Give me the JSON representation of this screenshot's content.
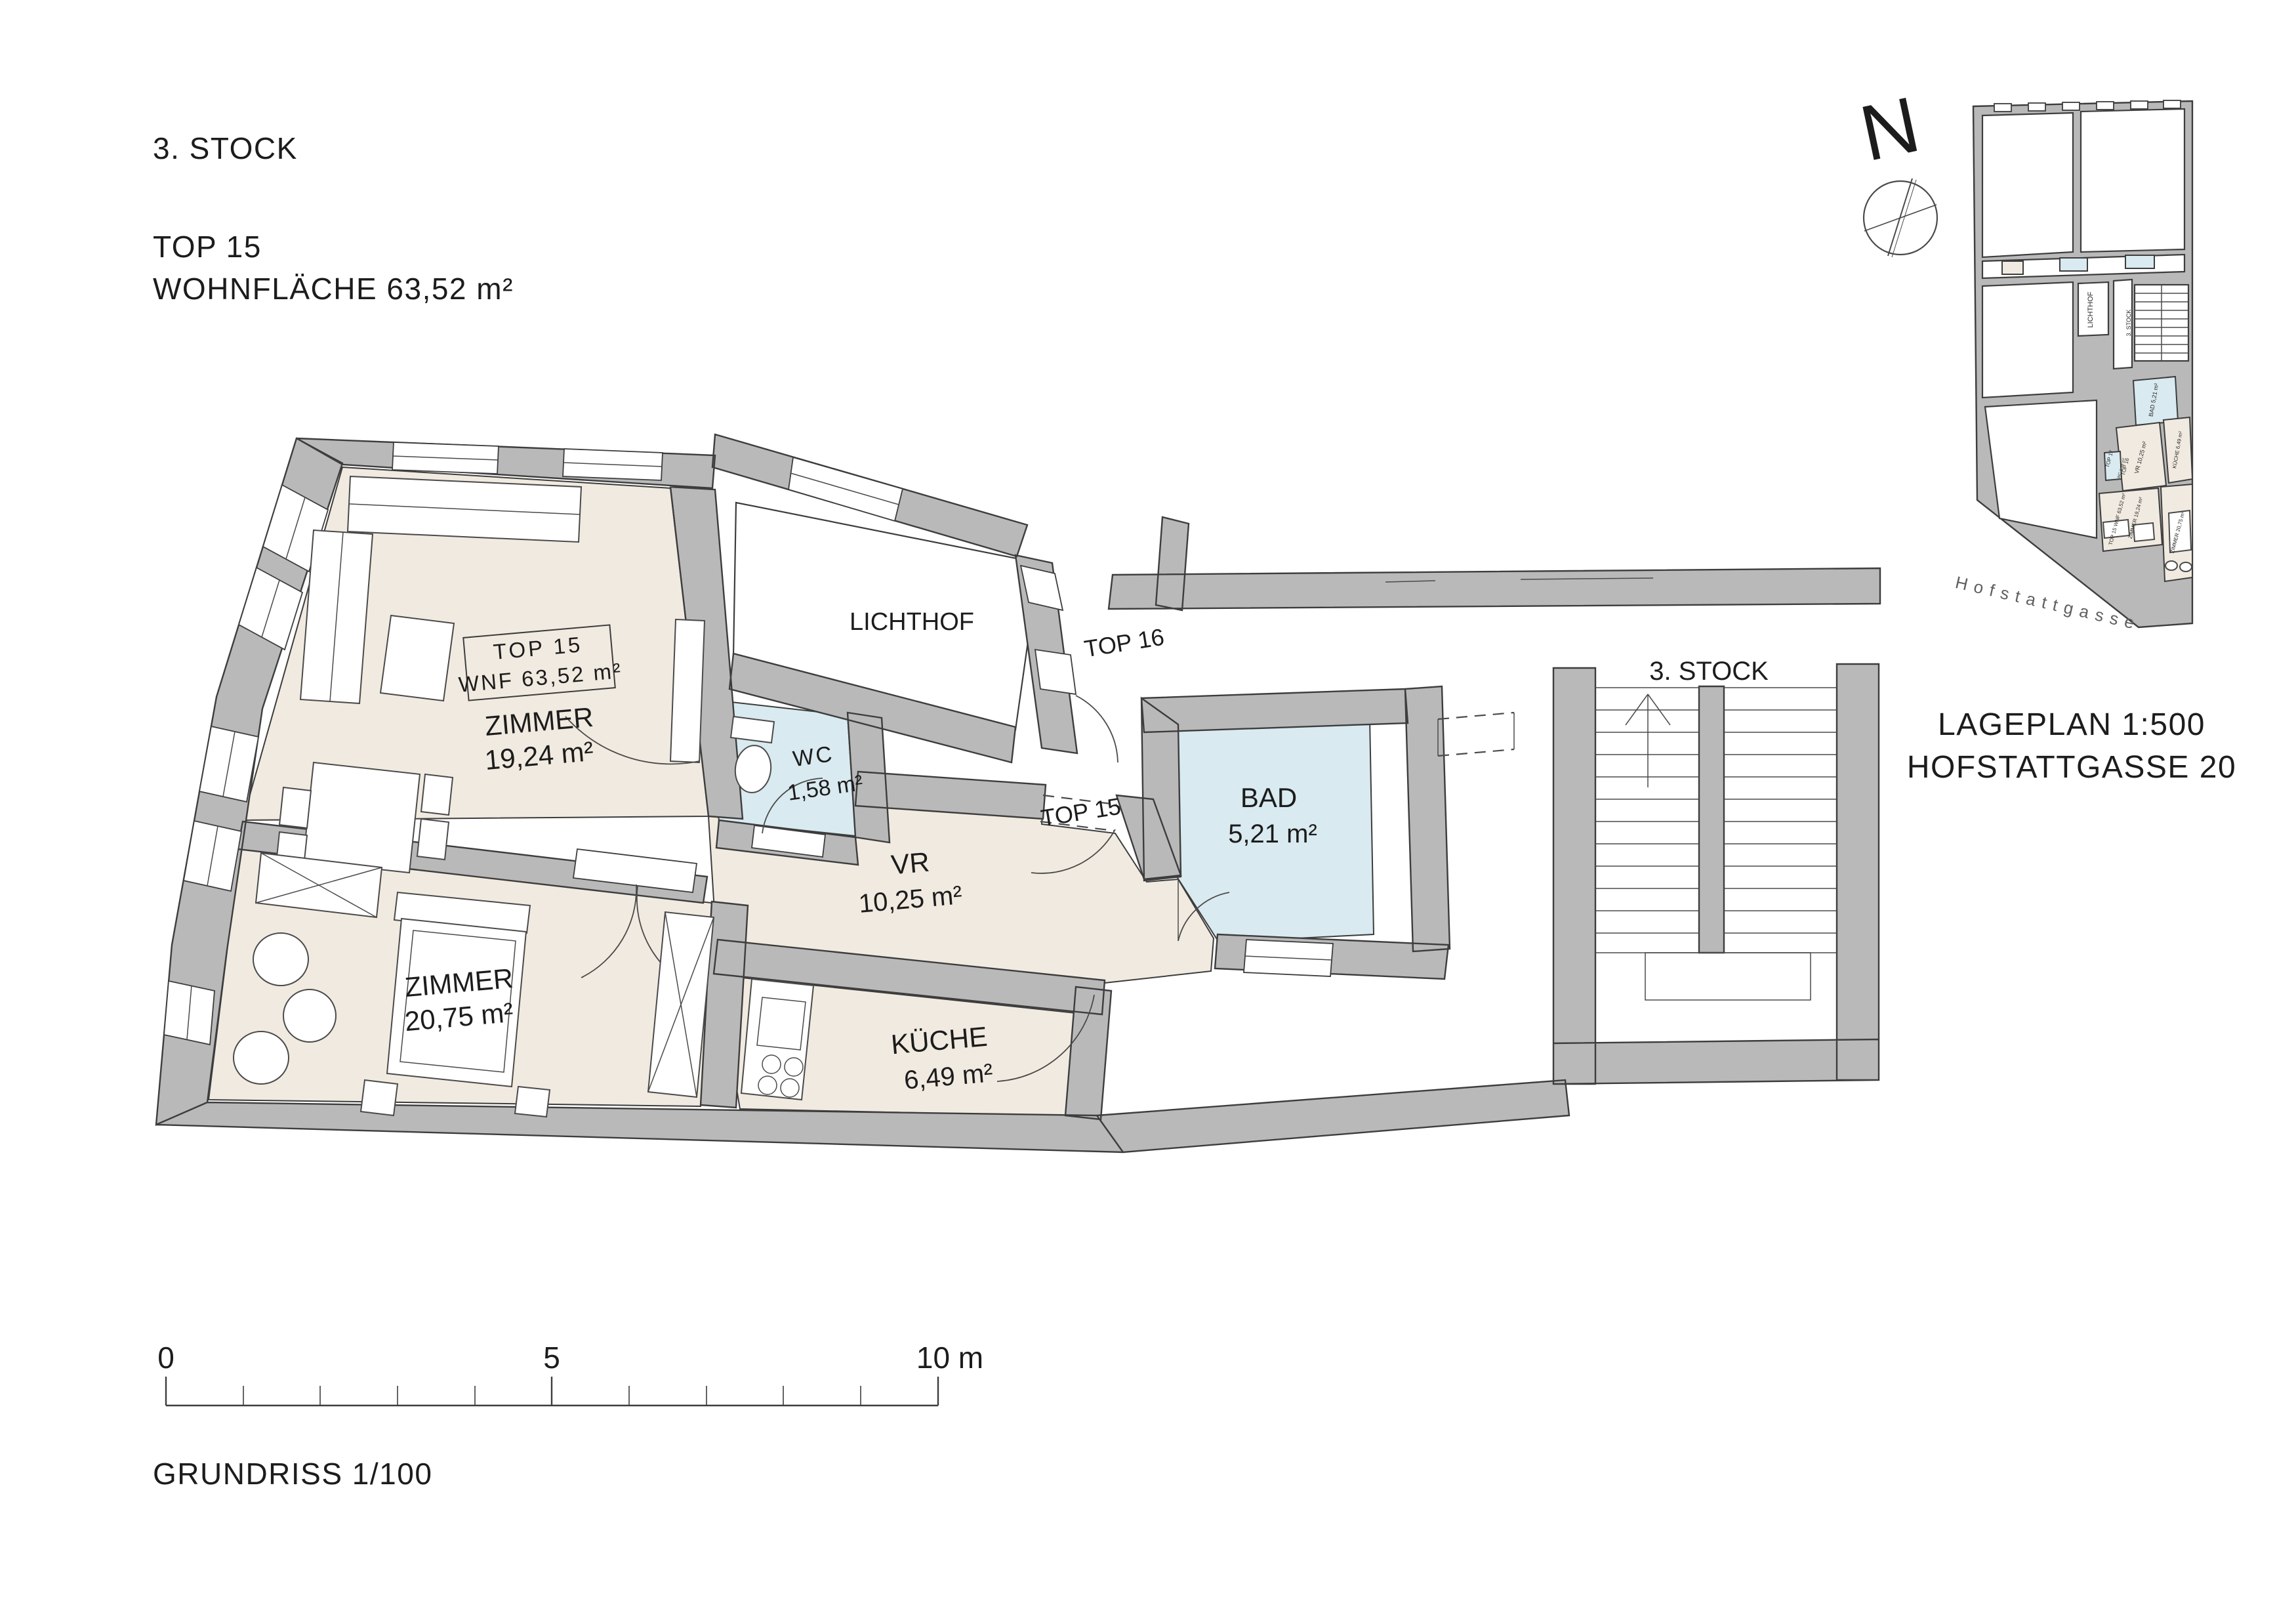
{
  "header": {
    "floor": "3. STOCK",
    "unit": "TOP  15",
    "area_line": "WOHNFLÄCHE 63,52 m²"
  },
  "plan": {
    "box": {
      "l1": "TOP 15",
      "l2": "WNF 63,52 m²"
    },
    "zimmer1": {
      "name": "ZIMMER",
      "area": "19,24 m²"
    },
    "zimmer2": {
      "name": "ZIMMER",
      "area": "20,75 m²"
    },
    "vr": {
      "name": "VR",
      "area": "10,25 m²"
    },
    "kueche": {
      "name": "KÜCHE",
      "area": "6,49 m²"
    },
    "wc": {
      "name": "WC",
      "area": "1,58 m²"
    },
    "bad": {
      "name": "BAD",
      "area": "5,21 m²"
    },
    "lichthof": "LICHTHOF",
    "door_top16": "TOP 16",
    "door_top15": "TOP 15",
    "stairs": "3. STOCK"
  },
  "siteplan": {
    "north_letter": "N",
    "title": "LAGEPLAN 1:500",
    "subtitle": "HOFSTATTGASSE 20",
    "street": "Hofstattgasse",
    "labels": {
      "lichthof": "LICHTHOF",
      "stock": "3. STOCK",
      "top17": "TOP 17",
      "top16": "TOP 16",
      "bad": "BAD 5,21 m²",
      "vr": "VR 10,25 m²",
      "kueche": "KÜCHE 6,49 m²",
      "wc": "WC 1,58 m²",
      "z19": "ZIMMER 19,24 m²",
      "z20": "ZIMMER 20,75 m²",
      "box": "TOP 15 WNF 63,52 m²"
    }
  },
  "scalebar": {
    "zero": "0",
    "five": "5",
    "ten": "10 m"
  },
  "footer": {
    "title": "GRUNDRISS 1/100"
  },
  "colors": {
    "wall": "#b9b9b9",
    "room_beige": "#f1eae0",
    "room_wet": "#d9eaf0",
    "line": "#3d3d3d"
  }
}
